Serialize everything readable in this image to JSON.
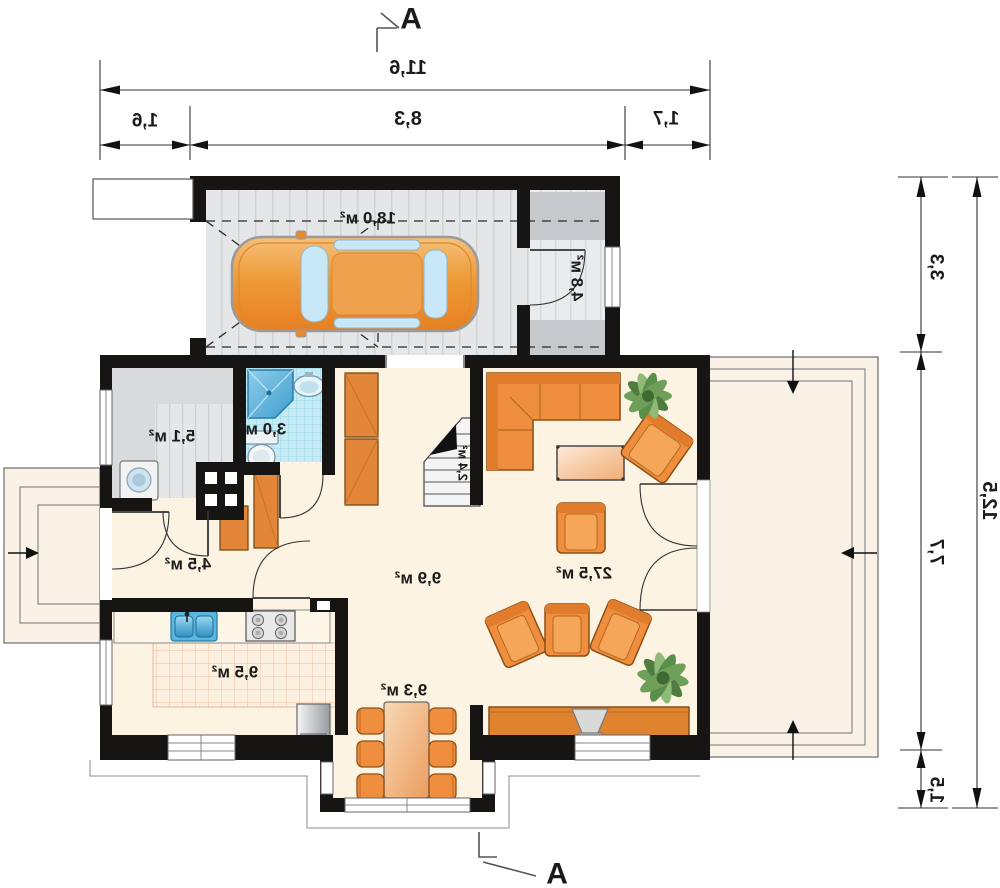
{
  "section": {
    "label": "A"
  },
  "dimensions": {
    "width_total": "11,6",
    "width_left": "1,6",
    "width_center": "8,3",
    "width_right": "1,7",
    "height_garage": "3,3",
    "height_main": "7,7",
    "height_bay": "1,5",
    "height_total": "12,5"
  },
  "rooms": {
    "garage": {
      "label": "18,0 м²"
    },
    "storage": {
      "label": "4,8 м²"
    },
    "utility": {
      "label": "5,1 м²"
    },
    "bathroom": {
      "label": "3,0 м²"
    },
    "hallway": {
      "label": "4,5 м²"
    },
    "hall": {
      "label": "9,9 м²"
    },
    "stairs": {
      "label": "2,4 м²"
    },
    "living_room": {
      "label": "27,5 м²"
    },
    "kitchen": {
      "label": "9,5 м²"
    },
    "dining_room": {
      "label": "9,3 м²"
    }
  },
  "colors": {
    "wall": "#171513",
    "floor_cream": "#fdf3e3",
    "garage_floor": "#e4e6e8",
    "bath_tile": "#c6ebf5",
    "kitchen_tile_line": "#ecbfa6",
    "furniture_orange": "#ee8e3e",
    "terrace": "#faf2e6",
    "glass_blue": "#c9e8f7"
  }
}
